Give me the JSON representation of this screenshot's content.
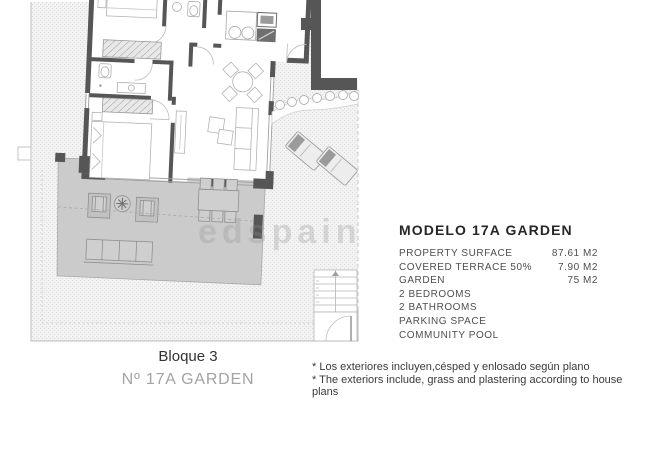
{
  "watermark": "edspain",
  "floor_plan": {
    "block_label": "Bloque 3",
    "unit_label": "Nº 17A GARDEN"
  },
  "info_panel": {
    "title": "MODELO 17A GARDEN",
    "rows": [
      {
        "label": "PROPERTY SURFACE",
        "value": "87.61 M2"
      },
      {
        "label": "COVERED TERRACE 50%",
        "value": "7.90 M2"
      },
      {
        "label": "GARDEN",
        "value": "75 M2"
      },
      {
        "label": "2 BEDROOMS",
        "value": ""
      },
      {
        "label": "2 BATHROOMS",
        "value": ""
      },
      {
        "label": "PARKING SPACE",
        "value": ""
      },
      {
        "label": "COMMUNITY POOL",
        "value": ""
      }
    ]
  },
  "footnotes": {
    "line_es": "* Los exteriores incluyen,césped y enlosado según plano",
    "line_en": "* The exteriors include, grass and plastering according to house plans"
  },
  "colors": {
    "wall": "#565656",
    "terrace": "#cbcbcb",
    "garden_hatch": "#dcdcdc",
    "drawing_line": "#b0b0b0",
    "text_dark": "#2b2b2b",
    "text_gray": "#a3a3a3"
  }
}
